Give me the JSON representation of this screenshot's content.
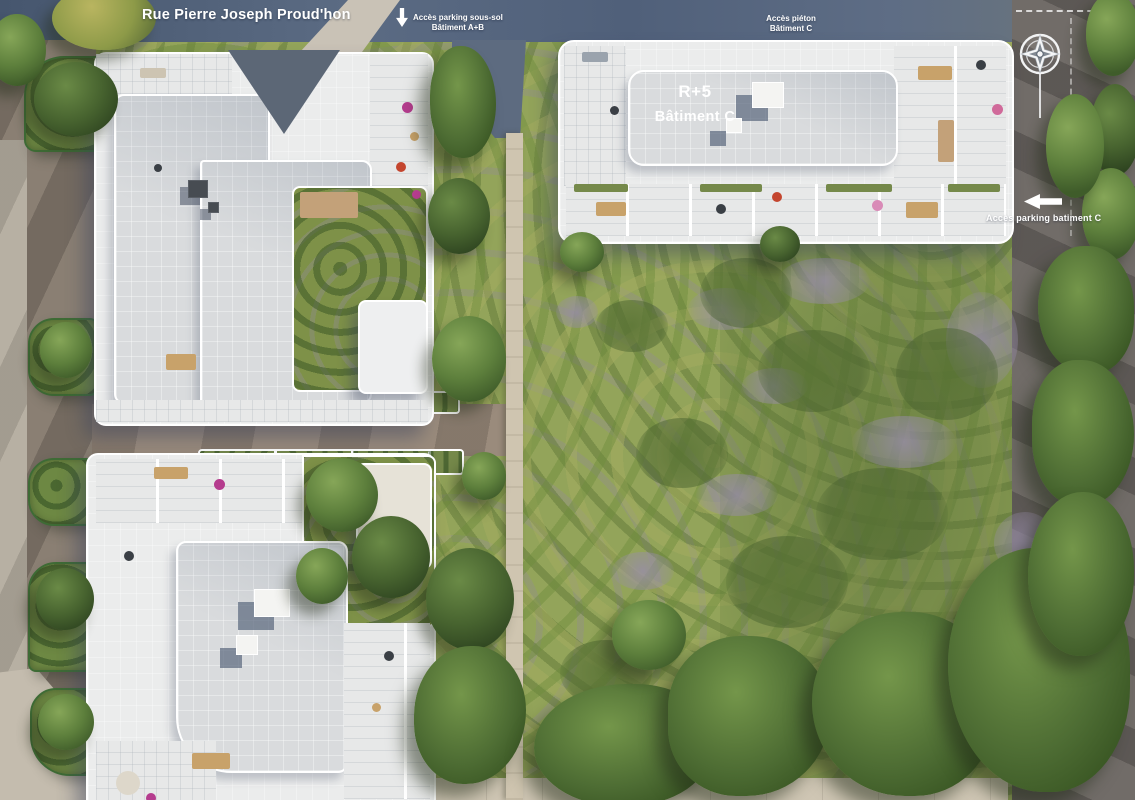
{
  "site_plan": {
    "type": "aerial-residence-site-plan",
    "street": {
      "name": "Rue Pierre Joseph Proud'hon"
    },
    "annotations": {
      "parking_ab": {
        "line1": "Accès parking sous-sol",
        "line2": "Bâtiment A+B",
        "icon": "down-arrow-icon"
      },
      "pieton_c": {
        "line1": "Accès piéton",
        "line2": "Bâtiment C"
      },
      "parking_c": {
        "label": "Accès parking batiment C",
        "icon": "left-arrow-icon"
      },
      "building_c": {
        "floors": "R+5",
        "name": "Bâtiment C"
      }
    },
    "icons": {
      "compass": "compass-rose-icon"
    },
    "colors": {
      "road_asphalt_blue": "#54637a",
      "road_taupe": "#857b70",
      "roof_white": "#ebecec",
      "roof_gray": "#d9dbdd",
      "meadow_green": "#93a45a",
      "tree_green": "#4e7034",
      "flower_purple": "#9288a6",
      "path_tan": "#cfc5b0",
      "label_white": "#ffffff",
      "umbrella_magenta": "#b53c8e"
    }
  }
}
